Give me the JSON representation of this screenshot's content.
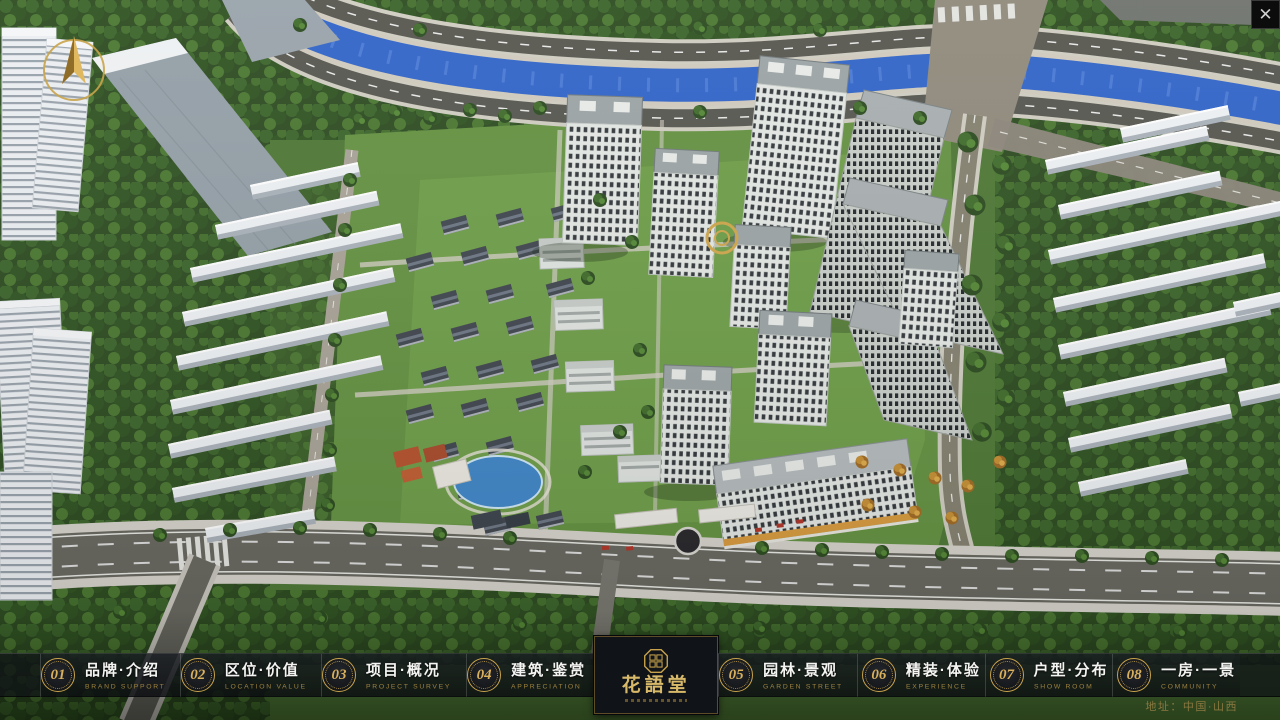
{
  "window": {
    "close_icon": "✕"
  },
  "logo": {
    "title": "花語堂"
  },
  "navbar": {
    "items": [
      {
        "num": "01",
        "label": "品牌·介绍",
        "sub": "BRAND SUPPORT"
      },
      {
        "num": "02",
        "label": "区位·价值",
        "sub": "LOCATION VALUE"
      },
      {
        "num": "03",
        "label": "项目·概况",
        "sub": "PROJECT SURVEY"
      },
      {
        "num": "04",
        "label": "建筑·鉴赏",
        "sub": "APPRECIATION"
      },
      {
        "num": "05",
        "label": "园林·景观",
        "sub": "GARDEN STREET"
      },
      {
        "num": "06",
        "label": "精装·体验",
        "sub": "EXPERIENCE"
      },
      {
        "num": "07",
        "label": "户型·分布",
        "sub": "SHOW ROOM"
      },
      {
        "num": "08",
        "label": "一房·一景",
        "sub": "COMMUNITY"
      }
    ]
  },
  "footer": {
    "address": "地址：中国·山西"
  },
  "colors": {
    "accent_gold": "#c8a34b",
    "bar_background": "#12151b",
    "river_blue": "#2f63c8"
  }
}
